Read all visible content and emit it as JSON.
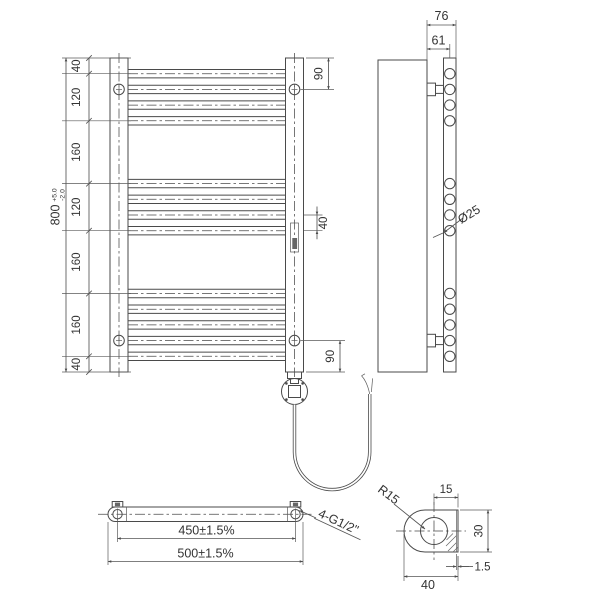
{
  "front_view": {
    "chain_dims": [
      "40",
      "120",
      "160",
      "120",
      "160",
      "160",
      "40"
    ],
    "overall_height": "800",
    "overall_tol_plus": "+5.0",
    "overall_tol_minus": "-2.0",
    "bracket_top_offset": "90",
    "rung_pitch": "40",
    "bracket_bottom_offset": "90"
  },
  "side_view": {
    "depth": "76",
    "wall_to_tube_center": "61",
    "tube_diameter": "Ø25"
  },
  "bottom_view": {
    "bracket_centers": "450±1.5%",
    "overall_width": "500±1.5%",
    "thread_spec": "4-G1/2\""
  },
  "section_detail": {
    "end_radius": "R15",
    "center_to_face": "15",
    "profile_height": "30",
    "profile_width": "40",
    "wall_thickness": "1.5"
  }
}
